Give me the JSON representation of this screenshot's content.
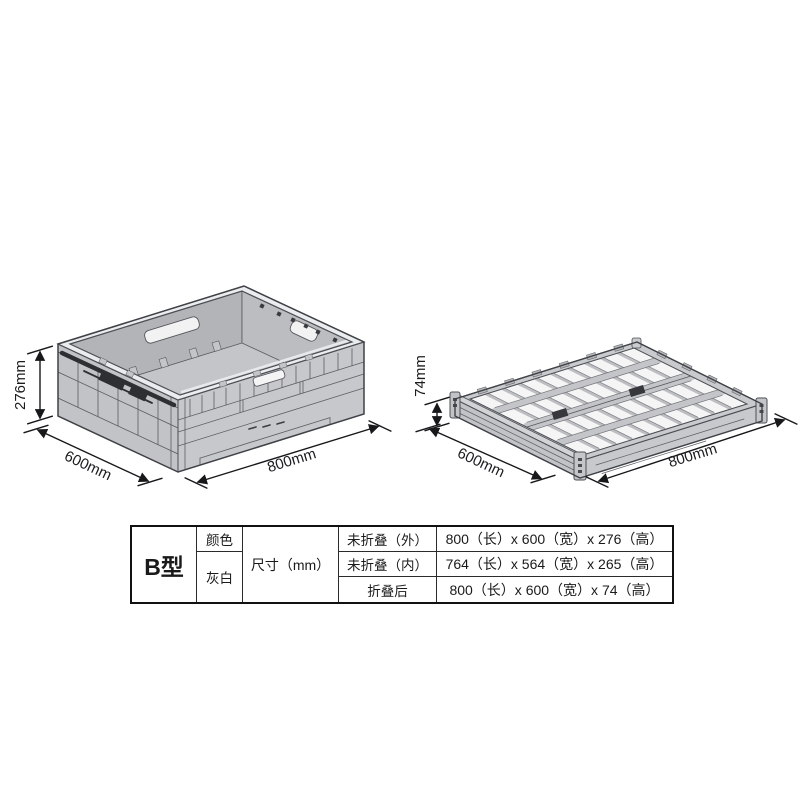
{
  "figures": {
    "unfolded": {
      "height_label": "276mm",
      "depth_label": "600mm",
      "width_label": "800mm"
    },
    "folded": {
      "height_label": "74mm",
      "depth_label": "600mm",
      "width_label": "800mm"
    }
  },
  "spec_table": {
    "model": "B型",
    "color_label": "颜色",
    "color_value": "灰白",
    "size_label": "尺寸（mm）",
    "rows": [
      {
        "condition": "未折叠（外）",
        "value": "800（长）x 600（宽）x 276（高）"
      },
      {
        "condition": "未折叠（内）",
        "value": "764（长）x 564（宽）x 265（高）"
      },
      {
        "condition": "折叠后",
        "value": "800（长）x 600（宽）x 74（高）"
      }
    ]
  },
  "colors": {
    "background": "#ffffff",
    "crate_gray": "#c7c8cb",
    "crate_interior_wall": "#b3b4b8",
    "crate_rim": "#ebeced",
    "lattice_cell": "#f5f5f6",
    "crate_outline": "#4b4e54",
    "latch_dark": "#2d2f33",
    "dimension_color": "#1b1c1e",
    "table_border": "#111111"
  }
}
